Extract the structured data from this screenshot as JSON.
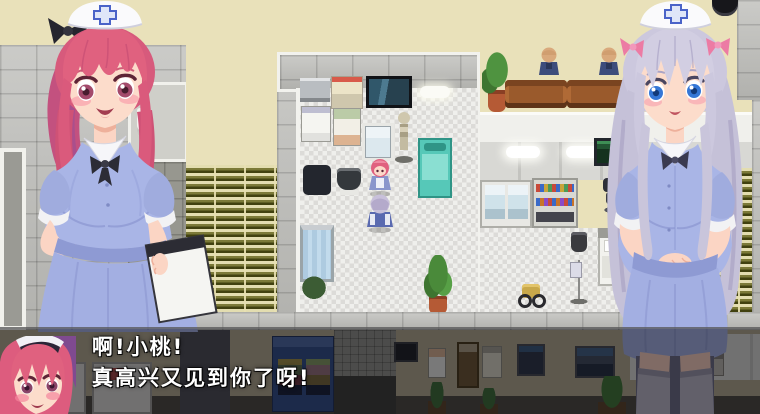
{
  "dialogue": {
    "line1": "啊!小桃!",
    "line2": "真高兴又见到你了呀!"
  },
  "colors": {
    "wall_cream": "#e9e1ba",
    "nurse_dress_blue": "#a9b5e6",
    "hair_pink": "#df5d80",
    "hair_silver": "#ccc8de",
    "cap_cross_blue": "#4a63c8",
    "exam_bed_teal": "#56c8b8",
    "couch_brown": "#9a5a2c",
    "vending_machine_blue": "#2e4a86",
    "dialogue_text": "#ffffff"
  }
}
